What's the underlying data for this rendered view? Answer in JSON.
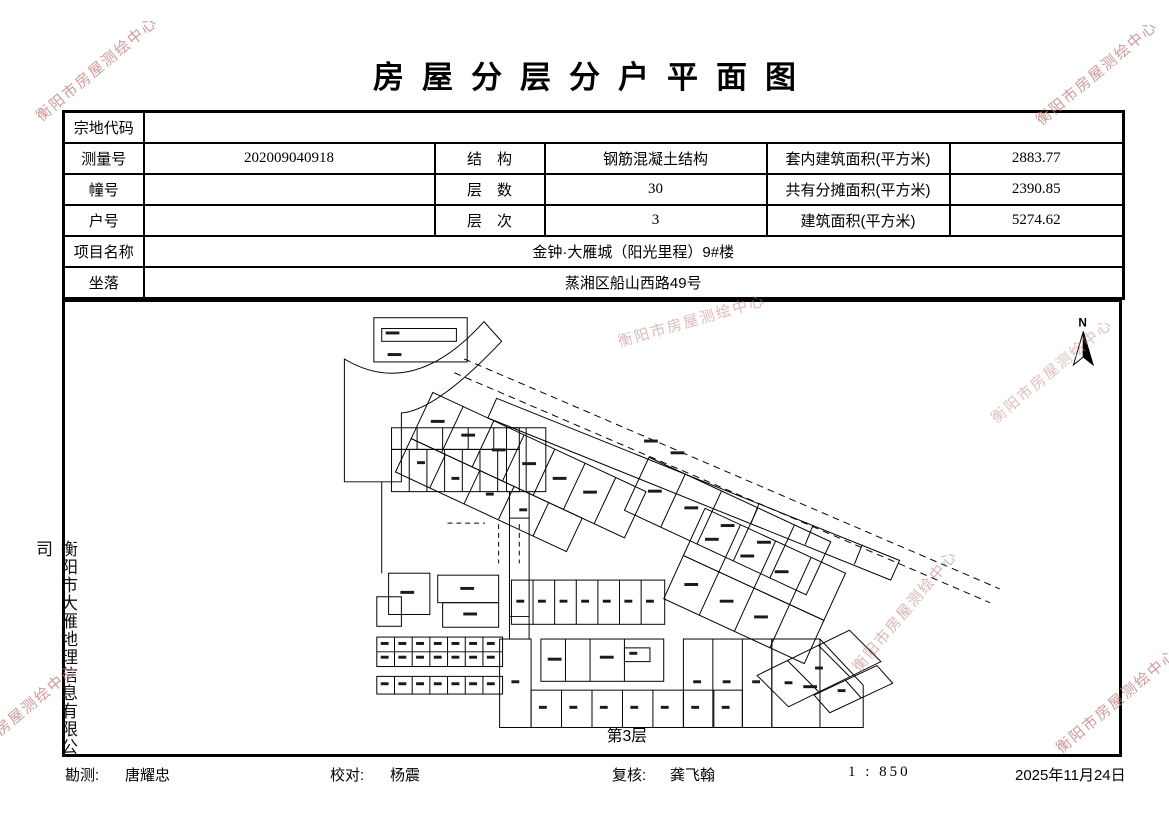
{
  "title": "房屋分层分户平面图",
  "watermark": {
    "text": "衡阳市房屋测绘中心",
    "color": "#c97f7f"
  },
  "table": {
    "parcel_label": "宗地代码",
    "parcel_value": "",
    "survey_no_label": "测量号",
    "survey_no": "202009040918",
    "structure_label": "结　构",
    "structure": "钢筋混凝土结构",
    "inner_area_label": "套内建筑面积(平方米)",
    "inner_area": "2883.77",
    "building_no_label": "幢号",
    "building_no": "",
    "floors_label": "层　数",
    "floors": "30",
    "shared_area_label": "共有分摊面积(平方米)",
    "shared_area": "2390.85",
    "unit_no_label": "户号",
    "unit_no": "",
    "level_label": "层　次",
    "level": "3",
    "total_area_label": "建筑面积(平方米)",
    "total_area": "5274.62",
    "project_label": "项目名称",
    "project": "金钟·大雁城（阳光里程）9#楼",
    "location_label": "坐落",
    "location": "蒸湘区船山西路49号"
  },
  "plan": {
    "floor_label": "第3层",
    "north_label": "N"
  },
  "side_company": "衡阳市大雁地理信息有限公司",
  "footer": {
    "survey_label": "勘测:",
    "survey_name": "唐耀忠",
    "check_label": "校对:",
    "check_name": "杨震",
    "review_label": "复核:",
    "review_name": "龚飞翰",
    "scale": "1 : 850",
    "date": "2025年11月24日"
  }
}
